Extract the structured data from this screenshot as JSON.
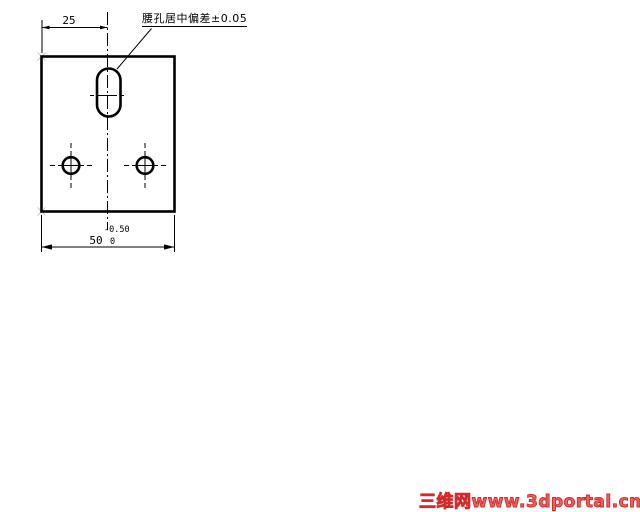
{
  "drawing": {
    "annotation_label": "腰孔居中偏差±0.05",
    "dim_top": "25",
    "dim_bottom": "50",
    "dim_bottom_tol_upper": "-0.50",
    "dim_bottom_tol_lower": "0"
  },
  "watermark": {
    "text": "三维网www.3dportal.cn",
    "color": "#d42a2a"
  },
  "colors": {
    "line": "#000000",
    "background": "#ffffff"
  }
}
